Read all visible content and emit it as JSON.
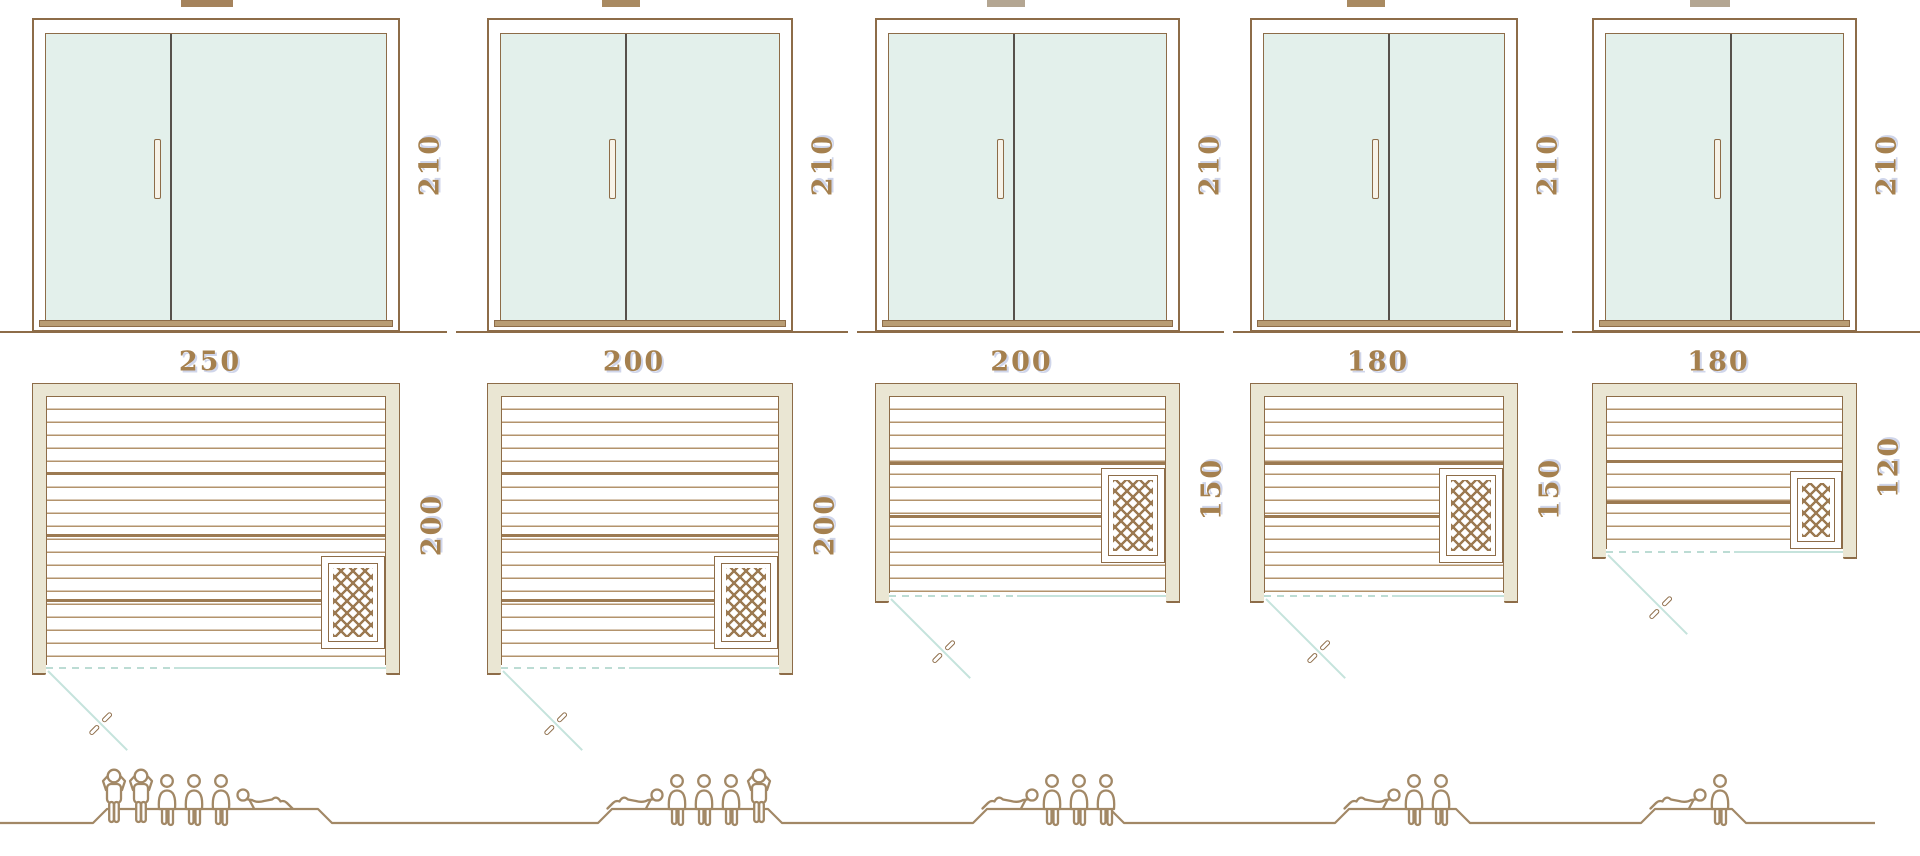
{
  "colors": {
    "outline": "#8d6c48",
    "glass": "#e3f0eb",
    "wall_fill": "#eae6d3",
    "slat": "#b3936c",
    "slat_dark": "#9c7a52",
    "teal_door": "#c5e3dc",
    "label_text": "#a5804e",
    "figure_stroke": "#a28866",
    "sill": "#b99d74",
    "door_divider": "#57514b"
  },
  "units": [
    {
      "id": "sauna-250x200",
      "height_label": "210",
      "width_label": "250",
      "depth_label": "200",
      "capacity": 6,
      "figures": [
        "standing",
        "standing",
        "sitting",
        "sitting",
        "sitting",
        "lying-flipped"
      ]
    },
    {
      "id": "sauna-200x200",
      "height_label": "210",
      "width_label": "200",
      "depth_label": "200",
      "capacity": 5,
      "figures": [
        "lying",
        "sitting",
        "sitting",
        "sitting",
        "standing"
      ]
    },
    {
      "id": "sauna-200x150",
      "height_label": "210",
      "width_label": "200",
      "depth_label": "150",
      "capacity": 4,
      "figures": [
        "lying",
        "sitting",
        "sitting",
        "sitting"
      ]
    },
    {
      "id": "sauna-180x150",
      "height_label": "210",
      "width_label": "180",
      "depth_label": "150",
      "capacity": 3,
      "figures": [
        "lying",
        "sitting",
        "sitting"
      ]
    },
    {
      "id": "sauna-180x120",
      "height_label": "210",
      "width_label": "180",
      "depth_label": "120",
      "capacity": 2,
      "figures": [
        "lying",
        "sitting"
      ]
    }
  ]
}
